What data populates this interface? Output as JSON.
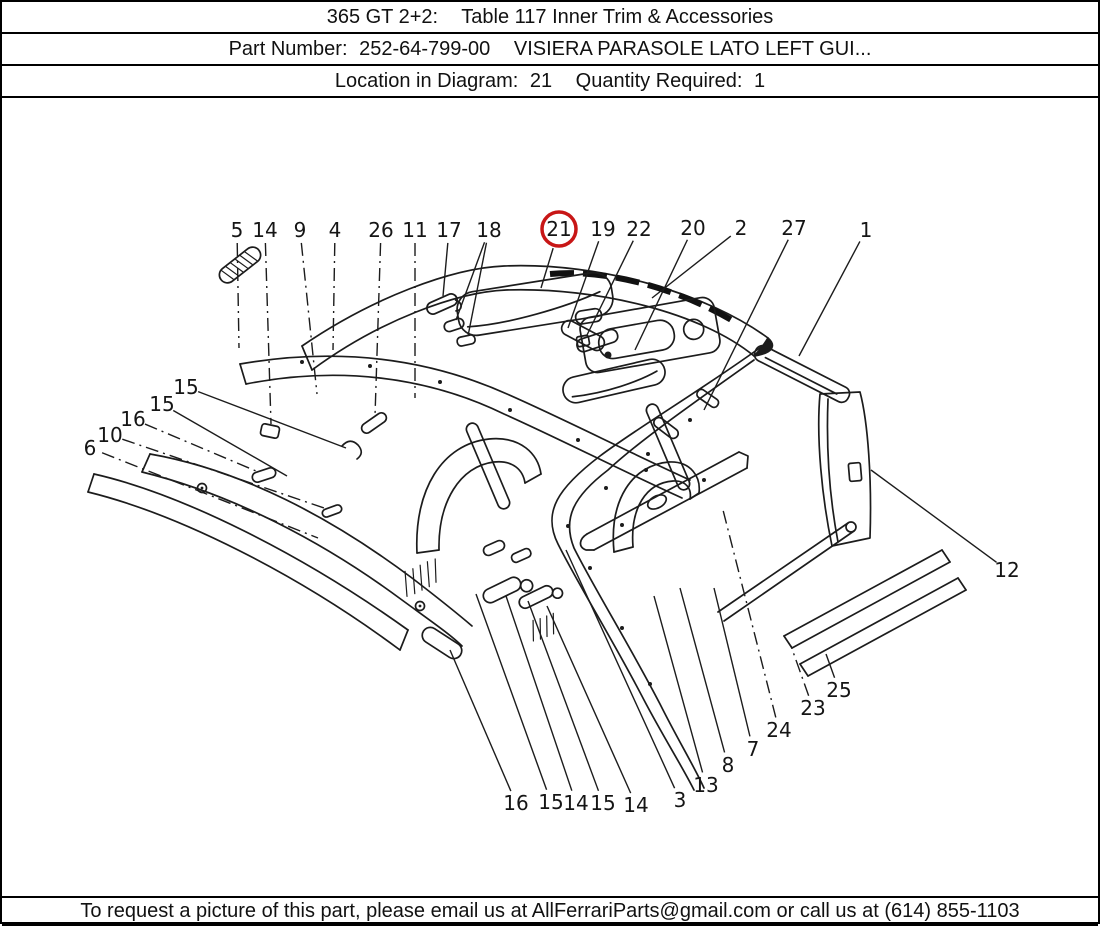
{
  "header": {
    "model": "365 GT 2+2:",
    "table_title": "Table 117 Inner Trim & Accessories",
    "part_number_label": "Part Number:",
    "part_number": "252-64-799-00",
    "part_description": "VISIERA PARASOLE LATO LEFT GUI...",
    "location_label": "Location in Diagram:",
    "location": "21",
    "quantity_label": "Quantity Required:",
    "quantity": "1"
  },
  "footer": {
    "contact_text": "To request a picture of this part, please email us at AllFerrariParts@gmail.com or call us at (614) 855-1103"
  },
  "diagram": {
    "ink_color": "#1c1c1c",
    "label_color": "#151515",
    "highlight_color": "#c81616",
    "highlighted_callout": "21",
    "callouts": [
      {
        "label": "5",
        "x": 235,
        "y": 132,
        "tx": 237,
        "ty": 250,
        "style": "dashdot"
      },
      {
        "label": "14",
        "x": 263,
        "y": 132,
        "tx": 269,
        "ty": 326,
        "style": "dashdot"
      },
      {
        "label": "9",
        "x": 298,
        "y": 132,
        "tx": 315,
        "ty": 296,
        "style": "dashdot"
      },
      {
        "label": "4",
        "x": 333,
        "y": 132,
        "tx": 331,
        "ty": 252,
        "style": "dashdot"
      },
      {
        "label": "26",
        "x": 379,
        "y": 132,
        "tx": 373,
        "ty": 318,
        "style": "dashdot"
      },
      {
        "label": "11",
        "x": 413,
        "y": 132,
        "tx": 413,
        "ty": 300,
        "style": "dashdot"
      },
      {
        "label": "17",
        "x": 447,
        "y": 132,
        "tx": 441,
        "ty": 198,
        "style": "solid"
      },
      {
        "label": "18",
        "x": 487,
        "y": 132,
        "tx": 454,
        "ty": 222,
        "style": "solid",
        "tx2": 466,
        "ty2": 238
      },
      {
        "label": "21",
        "x": 557,
        "y": 131,
        "tx": 539,
        "ty": 190,
        "style": "solid",
        "circled": true
      },
      {
        "label": "19",
        "x": 601,
        "y": 131,
        "tx": 566,
        "ty": 230,
        "style": "solid"
      },
      {
        "label": "22",
        "x": 637,
        "y": 131,
        "tx": 585,
        "ty": 237,
        "style": "solid"
      },
      {
        "label": "20",
        "x": 691,
        "y": 130,
        "tx": 633,
        "ty": 252,
        "style": "solid"
      },
      {
        "label": "2",
        "x": 739,
        "y": 130,
        "tx": 650,
        "ty": 200,
        "style": "solid"
      },
      {
        "label": "27",
        "x": 792,
        "y": 130,
        "tx": 702,
        "ty": 312,
        "style": "solid"
      },
      {
        "label": "1",
        "x": 864,
        "y": 132,
        "tx": 797,
        "ty": 258,
        "style": "solid"
      },
      {
        "label": "15",
        "x": 184,
        "y": 289,
        "tx": 344,
        "ty": 350,
        "style": "solid"
      },
      {
        "label": "15",
        "x": 160,
        "y": 306,
        "tx": 285,
        "ty": 378,
        "style": "solid"
      },
      {
        "label": "16",
        "x": 131,
        "y": 321,
        "tx": 254,
        "ty": 373,
        "style": "dashdot"
      },
      {
        "label": "10",
        "x": 108,
        "y": 337,
        "tx": 322,
        "ty": 410,
        "style": "dashdot"
      },
      {
        "label": "6",
        "x": 88,
        "y": 350,
        "tx": 316,
        "ty": 440,
        "style": "dashdot"
      },
      {
        "label": "16",
        "x": 514,
        "y": 705,
        "tx": 448,
        "ty": 552,
        "style": "solid"
      },
      {
        "label": "15",
        "x": 549,
        "y": 704,
        "tx": 474,
        "ty": 496,
        "style": "solid"
      },
      {
        "label": "14",
        "x": 574,
        "y": 705,
        "tx": 504,
        "ty": 498,
        "style": "solid"
      },
      {
        "label": "15",
        "x": 601,
        "y": 705,
        "tx": 526,
        "ty": 503,
        "style": "solid"
      },
      {
        "label": "14",
        "x": 634,
        "y": 707,
        "tx": 545,
        "ty": 508,
        "style": "solid"
      },
      {
        "label": "3",
        "x": 678,
        "y": 702,
        "tx": 564,
        "ty": 452,
        "style": "solid"
      },
      {
        "label": "13",
        "x": 704,
        "y": 687,
        "tx": 652,
        "ty": 498,
        "style": "solid"
      },
      {
        "label": "8",
        "x": 726,
        "y": 667,
        "tx": 678,
        "ty": 490,
        "style": "solid"
      },
      {
        "label": "7",
        "x": 751,
        "y": 651,
        "tx": 712,
        "ty": 490,
        "style": "solid"
      },
      {
        "label": "24",
        "x": 777,
        "y": 632,
        "tx": 721,
        "ty": 412,
        "style": "dashdot"
      },
      {
        "label": "23",
        "x": 811,
        "y": 610,
        "tx": 789,
        "ty": 548,
        "style": "dashdot"
      },
      {
        "label": "25",
        "x": 837,
        "y": 592,
        "tx": 824,
        "ty": 556,
        "style": "solid"
      },
      {
        "label": "12",
        "x": 1005,
        "y": 472,
        "tx": 869,
        "ty": 372,
        "style": "solid"
      }
    ]
  }
}
